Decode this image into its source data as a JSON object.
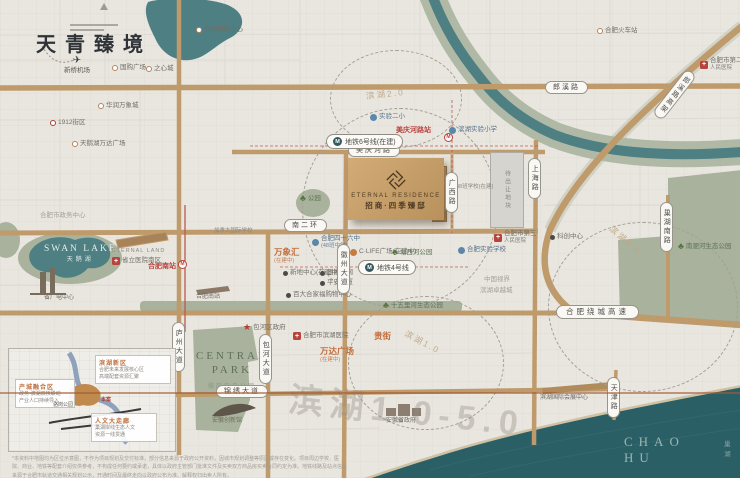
{
  "brand": {
    "slogan": "天青臻境",
    "en": "ETERNAL RESIDENCE",
    "cn": "招商·四季臻邸"
  },
  "waters": {
    "swan_en": "SWAN LAKE",
    "swan_cn": "天鹅湖",
    "chao_en": "CHAO HU",
    "chao_cn": "巢湖"
  },
  "park": {
    "en1": "CENTRAL",
    "en2": "PARK",
    "cn": "骆岗中央公园"
  },
  "parcel": {
    "label": "待出让地块"
  },
  "watermark": "滨湖1.0-5.0",
  "pois": [
    {
      "t": "dot",
      "l": "国购广场",
      "x": 112,
      "y": 64
    },
    {
      "t": "dot",
      "l": "之心城",
      "x": 146,
      "y": 65
    },
    {
      "t": "dot",
      "l": "合肥银泰中心",
      "x": 196,
      "y": 26
    },
    {
      "t": "red-dot",
      "l": "1912街区",
      "x": 50,
      "y": 119
    },
    {
      "t": "dot",
      "l": "华润万象城",
      "x": 98,
      "y": 102
    },
    {
      "t": "dot",
      "l": "天鹅湖万达广场",
      "x": 72,
      "y": 140
    },
    {
      "t": "plane",
      "l": "新桥机场",
      "x": 64,
      "y": 54
    },
    {
      "t": "faint",
      "l": "合肥市政务中心",
      "x": 40,
      "y": 212
    },
    {
      "t": "cap",
      "l": "省广电中心",
      "x": 44,
      "y": 295
    },
    {
      "t": "redtext",
      "l": "合肥南站",
      "x": 148,
      "y": 262
    },
    {
      "t": "mcircle",
      "l": "",
      "x": 178,
      "y": 260
    },
    {
      "t": "cap",
      "l": "合肥南站",
      "x": 196,
      "y": 294
    },
    {
      "t": "cap-en",
      "l": "ETERNAL LAND",
      "x": 112,
      "y": 248
    },
    {
      "t": "cross",
      "l": "省立医院南区",
      "x": 112,
      "y": 257
    },
    {
      "t": "blue-dot",
      "l": "实验二小",
      "x": 370,
      "y": 113
    },
    {
      "t": "blue-dot",
      "l": "滨湖实验小学",
      "x": 449,
      "y": 126
    },
    {
      "t": "redtext",
      "l": "美庆河路站",
      "x": 396,
      "y": 126
    },
    {
      "t": "mcircle",
      "l": "",
      "x": 444,
      "y": 133
    },
    {
      "t": "cross2",
      "l": "合肥市第二",
      "s": "人民医院",
      "x": 700,
      "y": 57
    },
    {
      "t": "cross2",
      "l": "合肥市第三",
      "s": "人民医院",
      "x": 494,
      "y": 230
    },
    {
      "t": "dark-dot",
      "l": "科创中心",
      "x": 550,
      "y": 233
    },
    {
      "t": "faint",
      "l": "中国视界",
      "x": 484,
      "y": 276
    },
    {
      "t": "faint",
      "l": "滨湖卓越城",
      "x": 480,
      "y": 287
    },
    {
      "t": "small",
      "l": "48班学校(在建)",
      "x": 456,
      "y": 184
    },
    {
      "t": "orange-b",
      "l": "万象汇",
      "s": "(在建中)",
      "x": 274,
      "y": 247
    },
    {
      "t": "blue-dot2",
      "l": "合肥四十六中",
      "s": "(48班中学)",
      "x": 312,
      "y": 235
    },
    {
      "t": "dark-dot",
      "l": "新地中心(在建中)",
      "x": 283,
      "y": 269
    },
    {
      "t": "dark-dot",
      "l": "国家电网",
      "x": 320,
      "y": 269
    },
    {
      "t": "dark-dot",
      "l": "平安大厦",
      "x": 320,
      "y": 279
    },
    {
      "t": "dark-dot",
      "l": "百大合家福购物中心",
      "x": 286,
      "y": 291
    },
    {
      "t": "orange-dot",
      "l": "C·LIFE广场(在建中)",
      "x": 350,
      "y": 248
    },
    {
      "t": "tree",
      "l": "塘西河公园",
      "x": 392,
      "y": 247
    },
    {
      "t": "blue-dot",
      "l": "合肥实验学校",
      "x": 458,
      "y": 246
    },
    {
      "t": "tree",
      "l": "十五里河生态公园",
      "x": 383,
      "y": 300
    },
    {
      "t": "tree",
      "l": "南淝河生态公园",
      "x": 678,
      "y": 241
    },
    {
      "t": "small",
      "l": "加拿大国际学校",
      "x": 214,
      "y": 228
    },
    {
      "t": "star",
      "l": "包河区政府",
      "x": 243,
      "y": 322
    },
    {
      "t": "cross",
      "l": "合肥市滨湖医院",
      "x": 293,
      "y": 332
    },
    {
      "t": "orange-b",
      "l": "万达广场",
      "s": "(在建中)",
      "x": 320,
      "y": 346
    },
    {
      "t": "orange-b",
      "l": "贵街",
      "x": 374,
      "y": 331
    },
    {
      "t": "cap",
      "l": "安徽创新馆",
      "x": 212,
      "y": 418
    },
    {
      "t": "cap",
      "l": "安徽省政府",
      "x": 386,
      "y": 418
    },
    {
      "t": "cap",
      "l": "滨湖国际会展中心",
      "x": 540,
      "y": 395
    },
    {
      "t": "tree",
      "l": "公园",
      "x": 300,
      "y": 193
    },
    {
      "t": "dot",
      "l": "合肥火车站",
      "x": 597,
      "y": 27
    }
  ],
  "roadPills": [
    {
      "l": "郎溪路",
      "o": "h",
      "x": 545,
      "y": 81
    },
    {
      "l": "美庆河路",
      "o": "h",
      "x": 348,
      "y": 144
    },
    {
      "l": "南二环",
      "o": "h",
      "x": 284,
      "y": 219
    },
    {
      "l": "锦绣大道",
      "o": "h",
      "x": 216,
      "y": 385
    },
    {
      "l": "合肥绕城高速",
      "o": "hw",
      "x": 556,
      "y": 305
    },
    {
      "l": "上海路",
      "o": "v",
      "x": 528,
      "y": 158
    },
    {
      "l": "庐州大道",
      "o": "v",
      "x": 172,
      "y": 322
    },
    {
      "l": "包河大道",
      "o": "v",
      "x": 259,
      "y": 334
    },
    {
      "l": "徽州大道",
      "o": "v",
      "x": 337,
      "y": 244
    },
    {
      "l": "广西路",
      "o": "v",
      "x": 445,
      "y": 172
    },
    {
      "l": "巢湖南路",
      "o": "v",
      "x": 660,
      "y": 202
    },
    {
      "l": "天津路",
      "o": "v",
      "x": 607,
      "y": 377
    },
    {
      "l": "郎溪路高架",
      "o": "d",
      "x": 668,
      "y": 66,
      "rot": 38
    }
  ],
  "metroPills": [
    {
      "l": "地铁6号线(在建)",
      "x": 326,
      "y": 134
    },
    {
      "l": "地铁4号线",
      "x": 358,
      "y": 260
    }
  ],
  "ringLabels": [
    {
      "l": "滨湖2.0",
      "x": 366,
      "y": 88,
      "rot": -6
    },
    {
      "l": "滨湖3.0",
      "x": 606,
      "y": 234,
      "rot": 40
    },
    {
      "l": "滨湖1.0",
      "x": 403,
      "y": 336,
      "rot": 28
    }
  ],
  "inset": {
    "b1": {
      "title": "滨湖新区",
      "l1": "合肥未来发展核心区",
      "l2": "高端配套资源汇聚"
    },
    "b2": {
      "title": "产城融合区",
      "l1": "政务·滨湖双核联动",
      "l2": "产业人口持续导入"
    },
    "b3": {
      "title": "人文大走廊",
      "l1": "巢湖岸线生态人文",
      "l2": "资源一线贯通"
    },
    "tag1": "骆岗公园",
    "tag2": "本案"
  },
  "disclaimer": "*本资料中地图均为区位示意图，不作为项目规划及交付标准，部分信息来源于政府公开资料，因城市规划调整等原因或存在变化。项目周边学校、医院、商业、地铁等配套介绍仅供参考，不构成任何要约或承诺，具体以政府主管部门批准文件及买卖双方商品房买卖合同约定为准。地铁线路及站点信息来源于合肥市轨道交通相关规划公示，开通时间及最终走向以政府公布为准。解释权归出卖人所有。"
}
